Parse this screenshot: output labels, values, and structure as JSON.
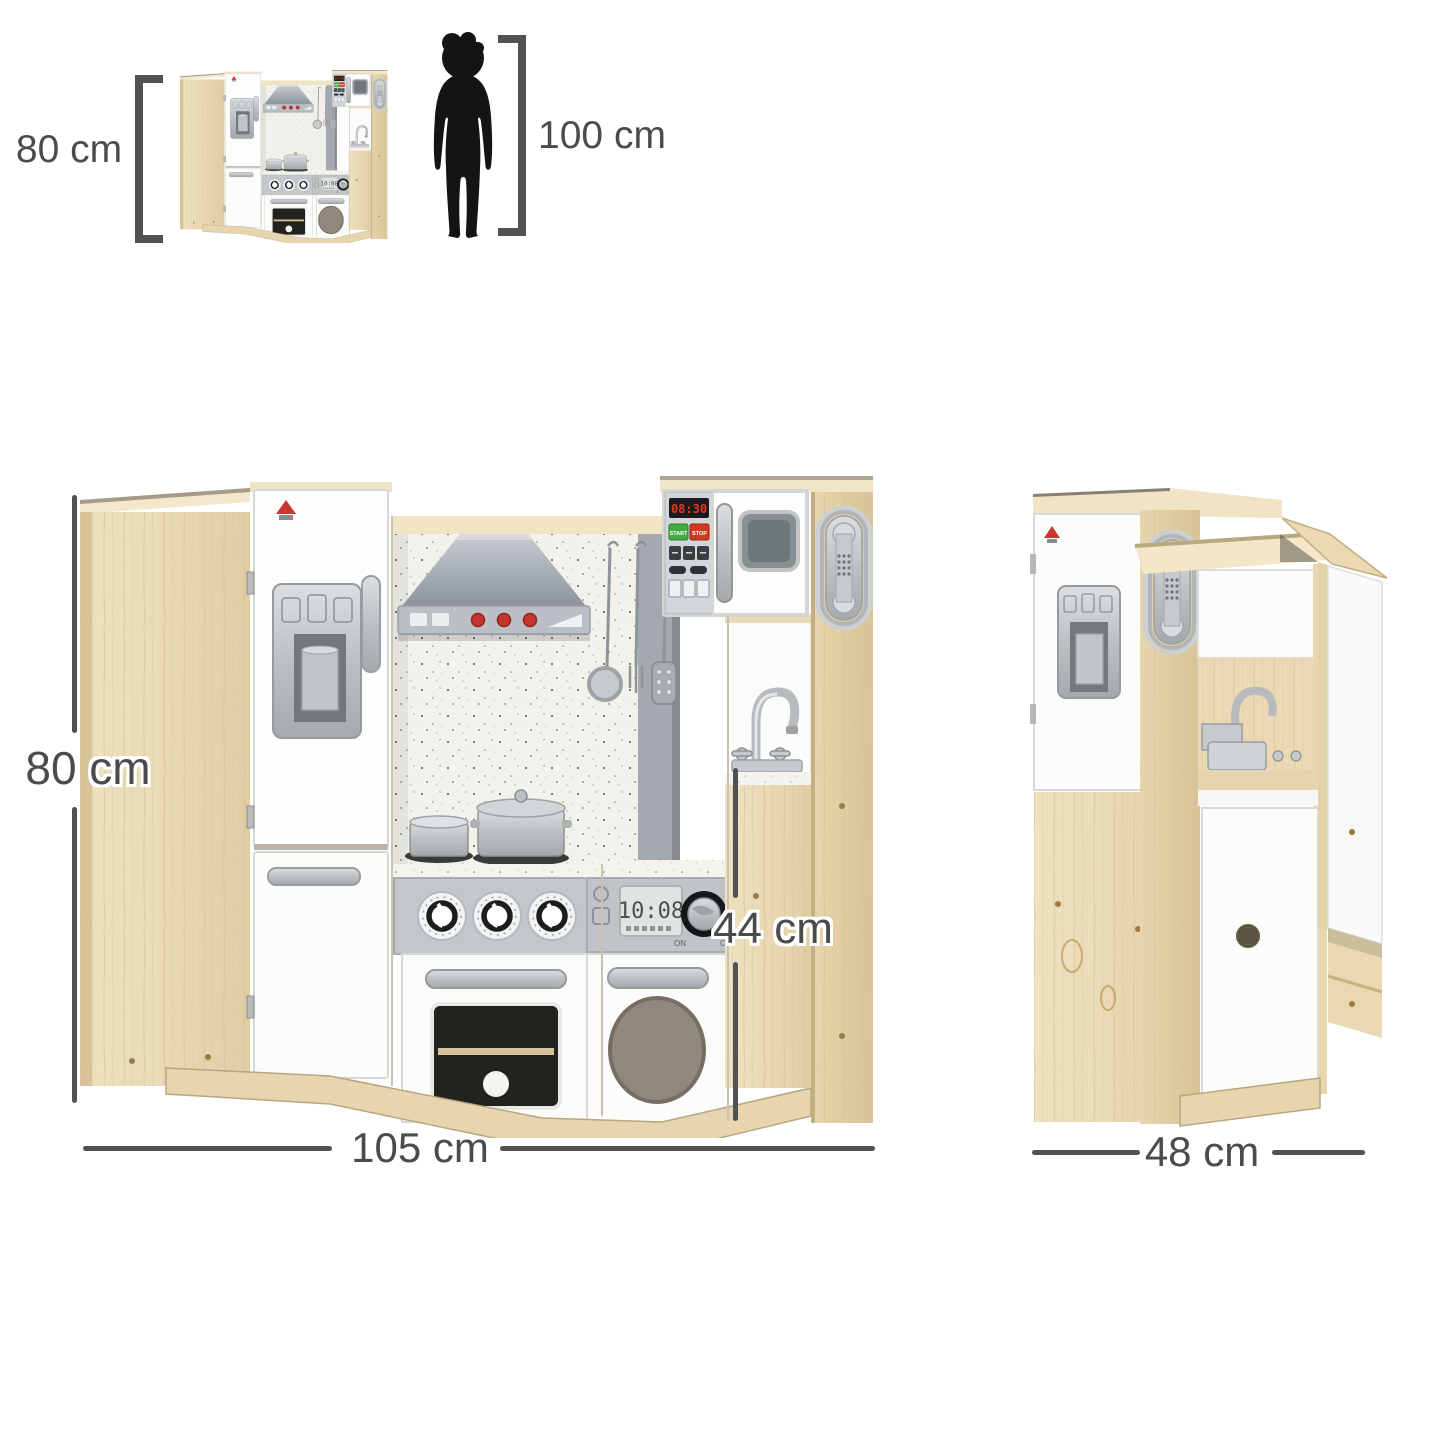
{
  "page": {
    "background": "#ffffff"
  },
  "top_scale": {
    "kitchen_height_label": "80 cm",
    "child_height_label": "100 cm"
  },
  "front_view": {
    "height_label": "80 cm",
    "width_label": "105 cm",
    "counter_height_label": "44 cm",
    "microwave": {
      "clock": "08:30",
      "start_button": "START",
      "stop_button": "STOP"
    },
    "washer": {
      "display_time": "10:08",
      "dial_on": "ON",
      "dial_off": "OFF"
    }
  },
  "side_view": {
    "depth_label": "48 cm"
  },
  "icons": [
    "child-silhouette-icon",
    "height-bracket-icon",
    "range-hood-icon",
    "ice-dispenser-icon",
    "wall-phone-icon",
    "faucet-icon",
    "ladle-icon",
    "fork-icon",
    "spatula-icon"
  ],
  "colors": {
    "dimension": "#4f5153",
    "label_text": "#4a4b4d",
    "silhouette": "#141414",
    "wood_light": "#ecdfbd",
    "wood_dark": "#d9c49a",
    "wood_top": "#f3e8cb",
    "white_panel": "#fcfcfb",
    "silver": "#c3c7ca",
    "hood_gray": "#a9b0b7",
    "display_red": "#e23a1c",
    "start_green": "#3fae3f",
    "stop_red": "#d43a22",
    "backsplash": "#f2f1eb"
  }
}
